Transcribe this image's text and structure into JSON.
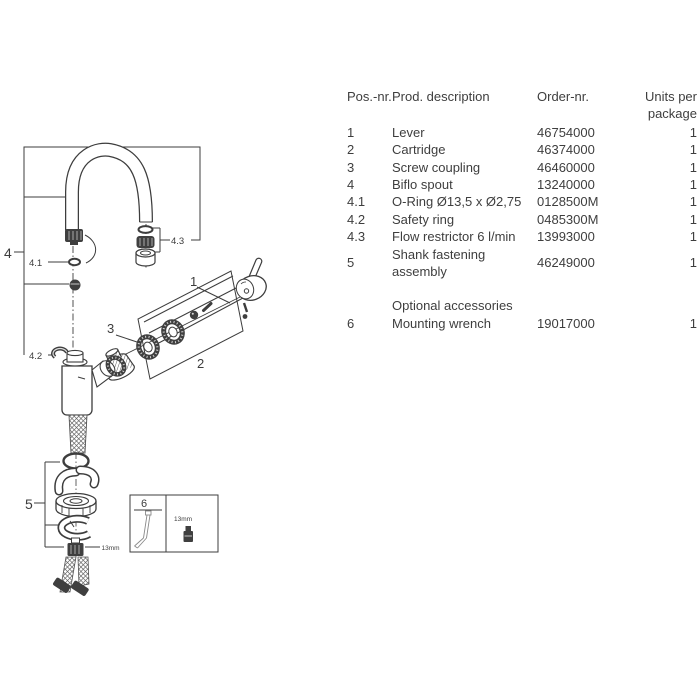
{
  "table": {
    "headers": {
      "pos": "Pos.-nr.",
      "description": "Prod. description",
      "order": "Order-nr.",
      "units": "Units per package"
    },
    "rows": [
      {
        "pos": "1",
        "desc": "Lever",
        "order": "46754000",
        "units": "1"
      },
      {
        "pos": "2",
        "desc": "Cartridge",
        "order": "46374000",
        "units": "1"
      },
      {
        "pos": "3",
        "desc": "Screw coupling",
        "order": "46460000",
        "units": "1"
      },
      {
        "pos": "4",
        "desc": "Biflo spout",
        "order": "13240000",
        "units": "1"
      },
      {
        "pos": "4.1",
        "desc": "O-Ring Ø13,5 x Ø2,75",
        "order": "0128500M",
        "units": "1"
      },
      {
        "pos": "4.2",
        "desc": "Safety ring",
        "order": "0485300M",
        "units": "1"
      },
      {
        "pos": "4.3",
        "desc": "Flow restrictor 6 l/min",
        "order": "13993000",
        "units": "1"
      },
      {
        "pos": "5",
        "desc": "Shank fastening assembly",
        "order": "46249000",
        "units": "1"
      },
      {
        "pos": "",
        "desc": "Optional accessories",
        "order": "",
        "units": ""
      },
      {
        "pos": "6",
        "desc": "Mounting wrench",
        "order": "19017000",
        "units": "1"
      }
    ]
  },
  "diagram": {
    "labels": {
      "part1": "1",
      "part2": "2",
      "part3": "3",
      "part4": "4",
      "part4_1": "4.1",
      "part4_2": "4.2",
      "part4_3": "4.3",
      "part5": "5",
      "part6": "6",
      "wrench_size": "13mm",
      "box_wrench_size": "13mm"
    },
    "line_color": "#3d3d3d"
  }
}
